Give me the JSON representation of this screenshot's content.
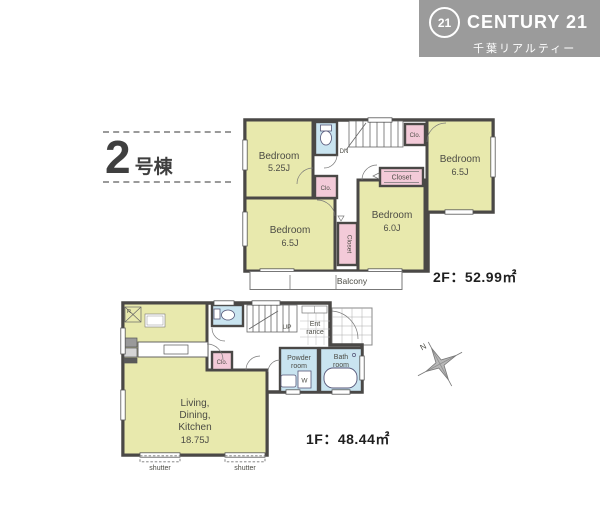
{
  "colors": {
    "wall": "#4a4846",
    "room": "#e8e9ad",
    "closet": "#f3cad8",
    "wet": "#c9e4f0",
    "brand_bg": "#9b9b9b",
    "thin_line": "#777777"
  },
  "brand": {
    "badge": "21",
    "name": "CENTURY 21",
    "subtitle": "千葉リアルティー"
  },
  "unit": {
    "number": "2",
    "label": "号棟"
  },
  "floor2": {
    "bedrooms": [
      {
        "name": "Bedroom",
        "size": "5.25J"
      },
      {
        "name": "Bedroom",
        "size": "6.5J"
      },
      {
        "name": "Bedroom",
        "size": "6.5J"
      },
      {
        "name": "Bedroom",
        "size": "6.0J"
      }
    ],
    "closets": {
      "top_right": "Clo.",
      "middle": "Closet",
      "mid_left": "Clo.",
      "vertical": "Closet"
    },
    "stair_label": "DN",
    "balcony_label": "Balcony",
    "area_label": "2F：52.99㎡"
  },
  "floor1": {
    "ldk": {
      "line1": "Living,",
      "line2": "Dining,",
      "line3": "Kitchen",
      "size": "18.75J"
    },
    "stair_label": "UP",
    "entrance": {
      "line1": "Ent",
      "line2": "rance"
    },
    "closet": "Clo.",
    "powder_room": {
      "line1": "Powder",
      "line2": "room"
    },
    "bath_room": {
      "line1": "Bath",
      "line2": "room"
    },
    "washer_label": "W",
    "fridge_label": "R",
    "shutters": [
      "shutter",
      "shutter"
    ],
    "area_label": "1F：48.44㎡"
  }
}
